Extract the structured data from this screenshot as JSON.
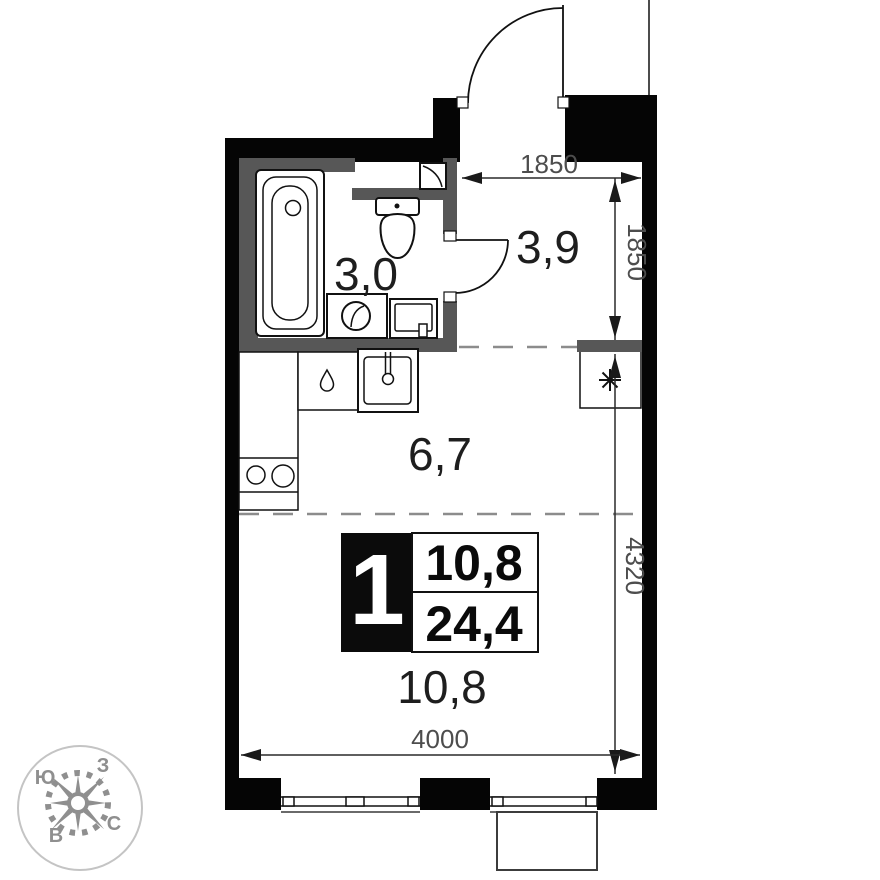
{
  "page": {
    "background": "#ffffff"
  },
  "plan": {
    "type": "studio-apartment-floor-plan",
    "rooms": [
      {
        "id": "bathroom",
        "area": "3,0"
      },
      {
        "id": "hallway",
        "area": "3,9"
      },
      {
        "id": "kitchen-zone",
        "area": "6,7"
      },
      {
        "id": "living-zone",
        "area": "10,8"
      }
    ],
    "info_badge": {
      "room_count": "1",
      "living_area": "10,8",
      "total_area": "24,4"
    },
    "dimensions": {
      "entry_width": "1850",
      "hallway_depth": "1850",
      "main_depth": "4320",
      "main_width": "4000"
    },
    "compass": {
      "south": "Ю",
      "west": "З",
      "north": "С",
      "east": "В"
    },
    "icons": {
      "niche_marker": "snowflake-asterisk",
      "vent_marker": "vent-flap",
      "kitchen_counter_marker": "water-drop"
    },
    "colors": {
      "wall": "#050505",
      "partition": "#575757",
      "dashed_zone": "#8c8c8c",
      "dimension_text": "#4d4d4d",
      "label_text": "#1e1e1e",
      "compass": "#8f8f8f"
    }
  }
}
